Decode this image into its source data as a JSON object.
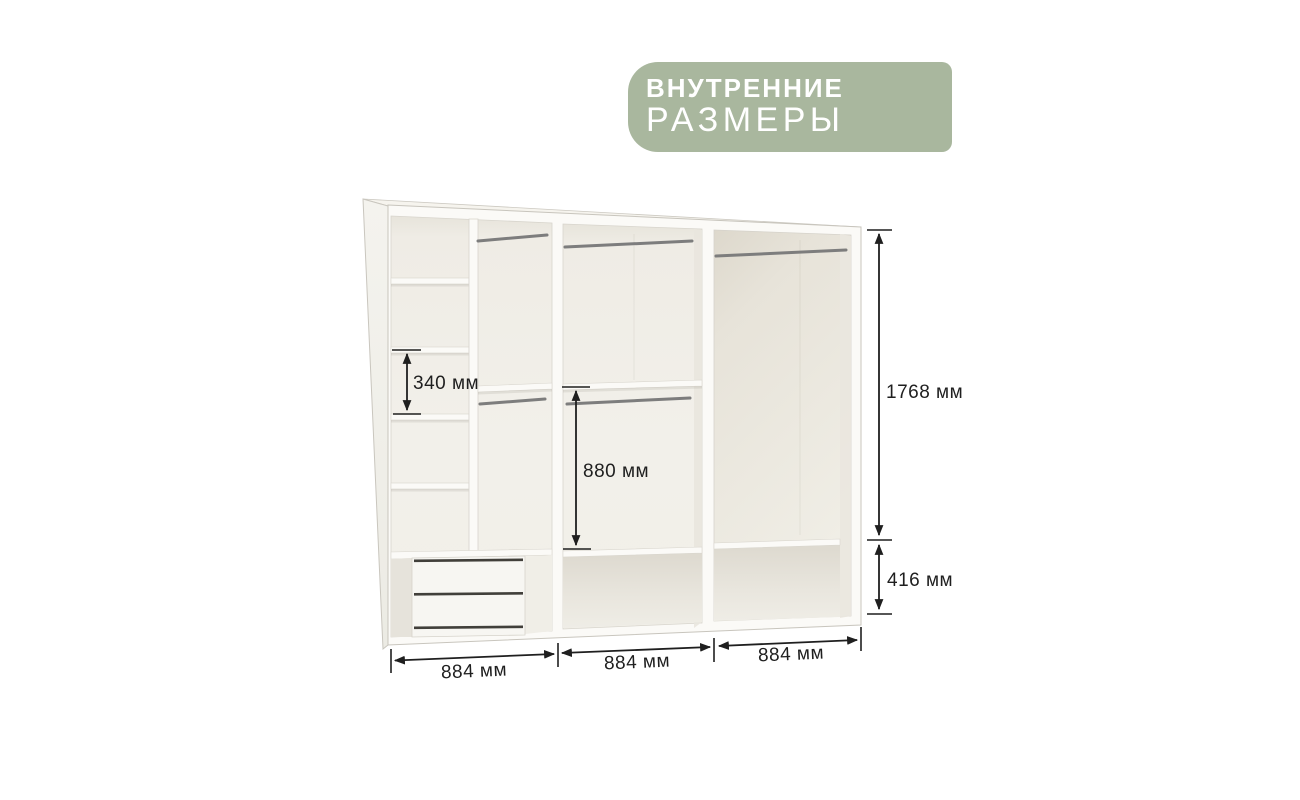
{
  "badge": {
    "line1": "ВНУТРЕННИЕ",
    "line2": "РАЗМЕРЫ",
    "bg_color": "#a9b79e",
    "text_color": "#ffffff"
  },
  "dimensions": {
    "d340": "340 мм",
    "d880": "880 мм",
    "d1768": "1768 мм",
    "d416": "416 мм",
    "w_left": "884 мм",
    "w_mid": "884 мм",
    "w_right": "884 мм"
  },
  "diagram": {
    "type": "wardrobe-interior-dimensions",
    "sections": 3,
    "hanging_rods": 5,
    "left_column_shelves": 5,
    "drawer_grooves": 3
  },
  "colors": {
    "dimension_lines": "#1f1f1f",
    "wardrobe_frame": "#fbfaf7",
    "interior_back": "#f1efe9",
    "background": "#ffffff"
  }
}
